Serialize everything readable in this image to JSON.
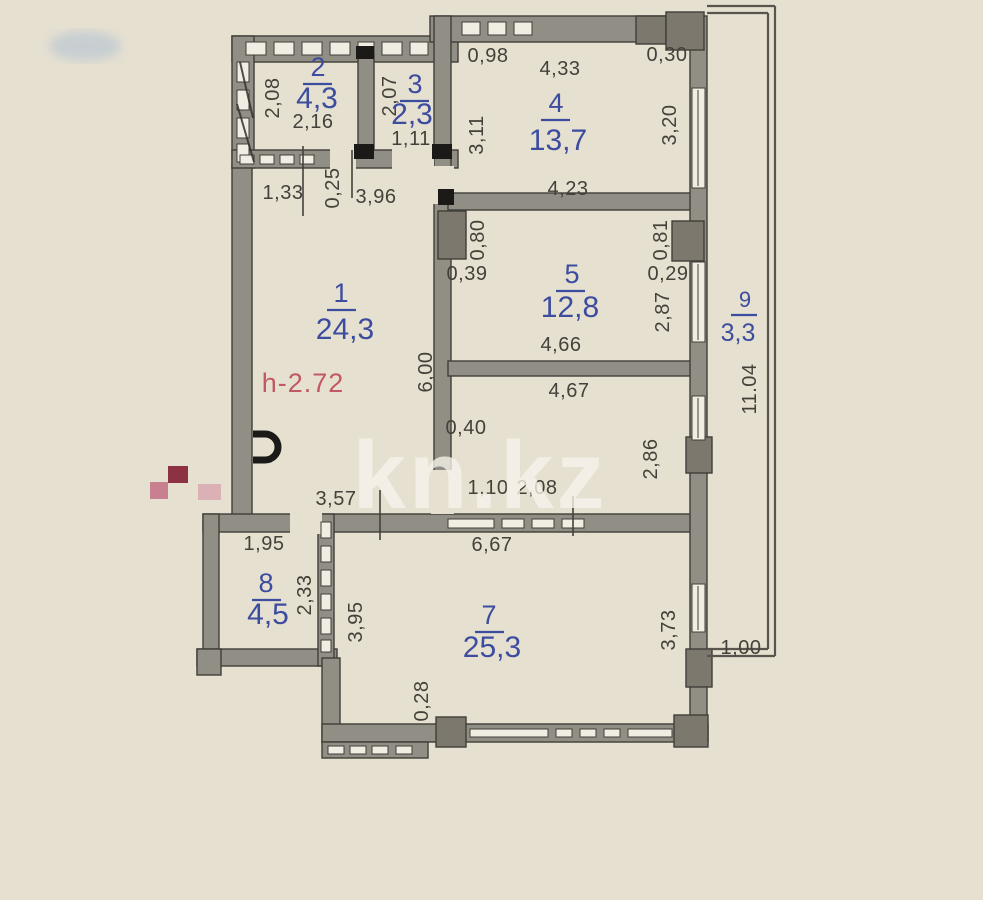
{
  "watermark": {
    "text": "kn.kz"
  },
  "colors": {
    "background": "#e6e0d1",
    "wall": "#918e85",
    "wall-dark": "#7c786e",
    "wall-outline": "#3f3e38",
    "opening": "#f0ede3",
    "room-text": "#3c4c9f",
    "dim-text": "#434139",
    "height-text": "#c15862",
    "watermark-text": "#f7f4ec",
    "door-black": "#1b1a18",
    "mark-dark-red": "#8d3242",
    "mark-pink": "#c87f90",
    "mark-light-pink": "#d9a5ae",
    "smudge-blue": "#a9bdd2"
  },
  "plan": {
    "height_note": "h-2.72",
    "rooms": [
      {
        "number": "1",
        "area": "24,3"
      },
      {
        "number": "2",
        "area": "4,3"
      },
      {
        "number": "3",
        "area": "2,3"
      },
      {
        "number": "4",
        "area": "13,7"
      },
      {
        "number": "5",
        "area": "12,8"
      },
      {
        "number": "7",
        "area": "25,3"
      },
      {
        "number": "8",
        "area": "4,5"
      },
      {
        "number": "9",
        "area": "3,3"
      }
    ],
    "dims": {
      "room2_h": "2,08",
      "room2_w": "2,16",
      "room3_h": "2,07",
      "room3_w": "1,11",
      "hall_left": "1,33",
      "hall_gap": "0,25",
      "hall_w": "3,96",
      "top_left": "0,98",
      "room4_w_top": "4,33",
      "top_right": "0,30",
      "room4_h_left": "3,11",
      "room4_h_right": "3,20",
      "room4_w_bottom": "4,23",
      "col5_left_v": "0,80",
      "col5_left_h": "0,39",
      "col5_right_v": "0,81",
      "col5_right_h": "0,29",
      "room5_h_right": "2,87",
      "room5_w_bottom": "4,66",
      "corridor_w_top": "4,67",
      "corridor_left": "0,40",
      "corridor_h_right": "2,86",
      "corridor_b1": "1,10",
      "corridor_b2": "2,08",
      "room1_h_right": "6,00",
      "hall_bottom_w": "3,57",
      "room8_w_top": "1,95",
      "room8_h_right": "2,33",
      "room8_outer_v": "3,95",
      "room7_w_top": "6,67",
      "room7_h_right": "3,73",
      "room7_offset": "0,28",
      "balcony_bottom_w": "1,00",
      "balcony_h": "11.04"
    }
  }
}
